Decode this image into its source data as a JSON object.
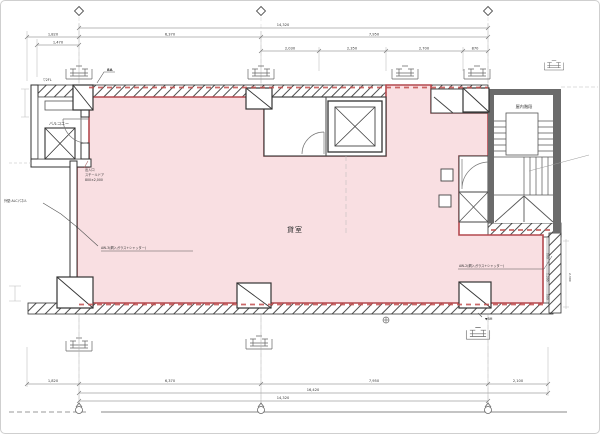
{
  "labels": {
    "room": "貸室",
    "balcony": "バルコニー",
    "stair": "屋内階段",
    "level_mark": "▽2FL",
    "grid_mark": "8A",
    "bench_mark": "▼BM"
  },
  "annotations": {
    "entrance_1": "出入口",
    "entrance_2": "スチールドア",
    "entrance_3": "800×2,000",
    "exterior_wall": "外壁:ALCパネル",
    "window_left": "AW-3(網入ガラス+シャッター)",
    "window_right": "AW-2(網入ガラス+シャッター)"
  },
  "dimensions": {
    "top": {
      "total": "14,320",
      "left_ext": "1,820",
      "span_left": "6,370",
      "span_right": "7,950",
      "small": "1,470",
      "sub_1": "2,030",
      "sub_2": "2,350",
      "sub_3": "2,700",
      "sub_4": "870"
    },
    "bottom": {
      "seg_1": "1,820",
      "seg_2": "6,370",
      "seg_3": "7,950",
      "seg_4": "2,100",
      "total_right": "16,420",
      "total": "14,320"
    },
    "side": {
      "w1": "500",
      "w2": "1,200",
      "w3": "500",
      "height": "2,300"
    }
  },
  "colors": {
    "tenant_fill": "#f9dfe2",
    "tenant_outline": "#b4494e",
    "wall": "#4a4a4a",
    "red_accent": "#c2504f"
  }
}
